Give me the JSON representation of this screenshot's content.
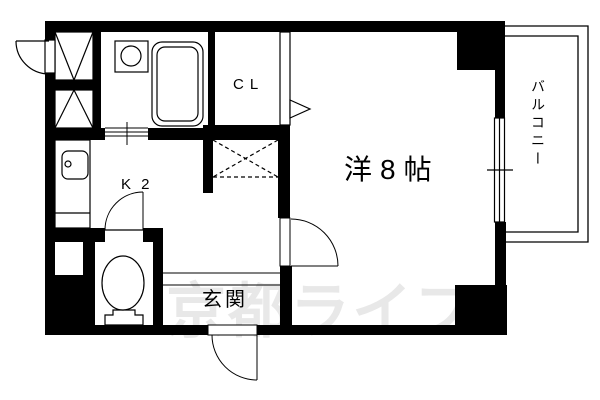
{
  "rooms": {
    "main_room": "洋8帖",
    "kitchen": "K 2",
    "closet": "CL",
    "entrance": "玄関",
    "balcony": "バルコニー"
  },
  "watermark": "京都ライフ",
  "colors": {
    "wall": "#000000",
    "line": "#000000",
    "watermark": "#e8e8e8",
    "background": "#ffffff"
  }
}
